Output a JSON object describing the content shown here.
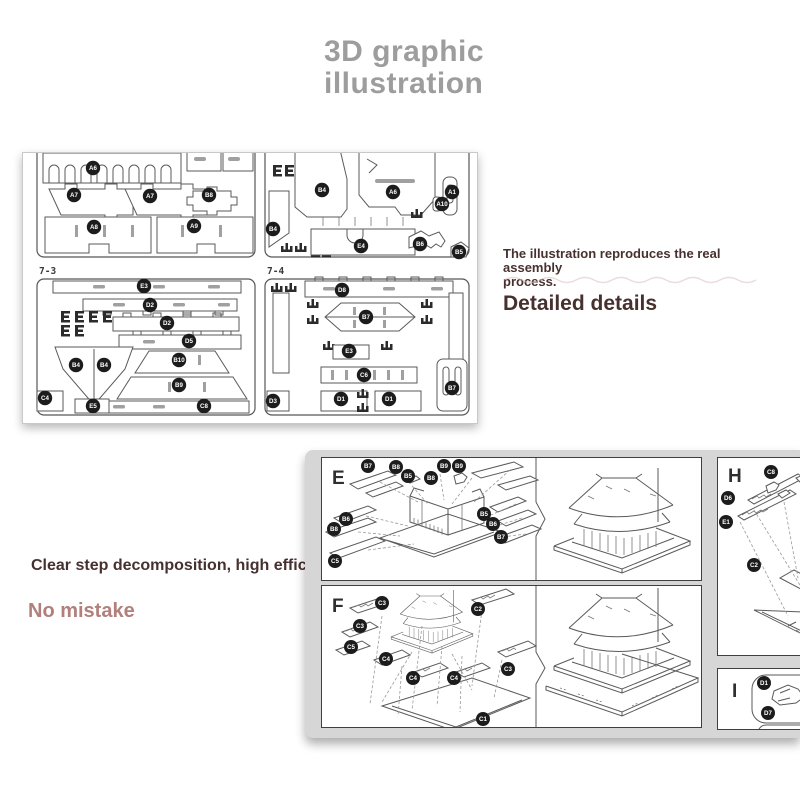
{
  "title": {
    "line1": "3D graphic",
    "line2": "illustration"
  },
  "captions": {
    "note_line1": "The illustration reproduces the real assembly",
    "note_line2": "process.",
    "detailed": "Detailed details",
    "clear_step": "Clear step decomposition, high efficiency",
    "no_mistake": "No mistake"
  },
  "colors": {
    "title": "#9d9d9d",
    "dark_text": "#47312f",
    "accent_text": "#b2807c",
    "line_art": "#5a5a5a",
    "label_bg": "#1c1c1c",
    "backdrop": "#d6d6d6",
    "panel_border": "#3f3f3f"
  },
  "sheets": {
    "sheet1": {
      "labels": [
        "A6",
        "A7",
        "A7",
        "B8",
        "A8",
        "A9"
      ]
    },
    "sheet2": {
      "labels": [
        "B4",
        "A6",
        "A1",
        "A10",
        "B4",
        "E4",
        "B6",
        "B5"
      ]
    },
    "sheet3": {
      "id": "7-3",
      "labels": [
        "E3",
        "D2",
        "D2",
        "D5",
        "B4",
        "B4",
        "B10",
        "B9",
        "C4",
        "E5",
        "C8"
      ]
    },
    "sheet4": {
      "id": "7-4",
      "labels": [
        "D8",
        "B7",
        "E3",
        "C6",
        "D1",
        "D1",
        "D3",
        "B7"
      ]
    }
  },
  "steps": {
    "e": {
      "letter": "E",
      "labels": [
        "B7",
        "B8",
        "B5",
        "B9",
        "B9",
        "B8",
        "B6",
        "B8",
        "C5",
        "B5",
        "B6",
        "B7"
      ]
    },
    "f": {
      "letter": "F",
      "labels": [
        "C3",
        "C2",
        "C3",
        "C5",
        "C4",
        "C4",
        "C4",
        "C3",
        "C1"
      ]
    },
    "h": {
      "letter": "H",
      "labels": [
        "C8",
        "D6",
        "E1",
        "C2"
      ]
    },
    "i": {
      "letter": "I",
      "labels": [
        "D1",
        "D7"
      ]
    }
  }
}
